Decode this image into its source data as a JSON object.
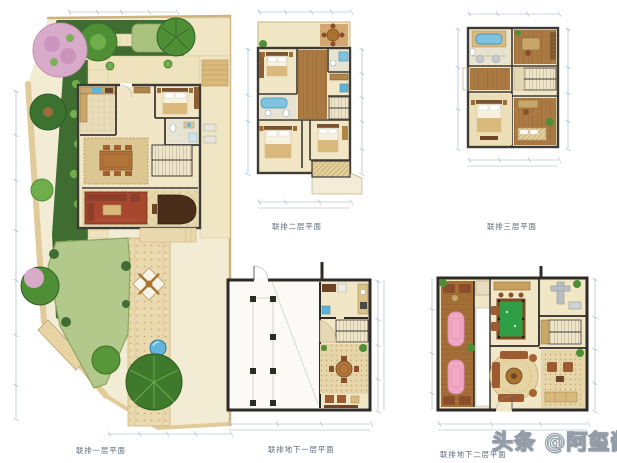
{
  "page": {
    "background_color": "#ffffff"
  },
  "plans": {
    "first_floor": {
      "caption": "联排一层平面"
    },
    "second_floor": {
      "caption": "联排二层平面"
    },
    "third_floor": {
      "caption": "联排三层平面"
    },
    "basement_one": {
      "caption": "联排地下一层平面"
    },
    "basement_two": {
      "caption": "联排地下二层平面"
    }
  },
  "watermark": {
    "text": "头条 @阿玺酱"
  },
  "colors": {
    "wall": "#3e3a34",
    "basement_wall": "#2e2a26",
    "floor_cream": "#f1e6c6",
    "wood_floor": "#ab7a42",
    "furniture_wood": "#8a4f2a",
    "counter_wood": "#c9a76a",
    "lawn_green": "#b3c88b",
    "hedge_green": "#3f6c30",
    "tree_green": "#4e8f35",
    "blossom_pink": "#d9abca",
    "water_blue": "#62b4d8",
    "fixture_blue": "#7ec4e0",
    "pool_table_green": "#2f9e44",
    "massage_table_pink": "#f2a7c3",
    "path_tan": "#ead9ae",
    "rug_red": "#a6472e",
    "caption_text": "#5f6b7a",
    "dimension_line": "#9fb0bf",
    "watermark_fill": "#ffffff",
    "watermark_outline": "#949da7"
  }
}
